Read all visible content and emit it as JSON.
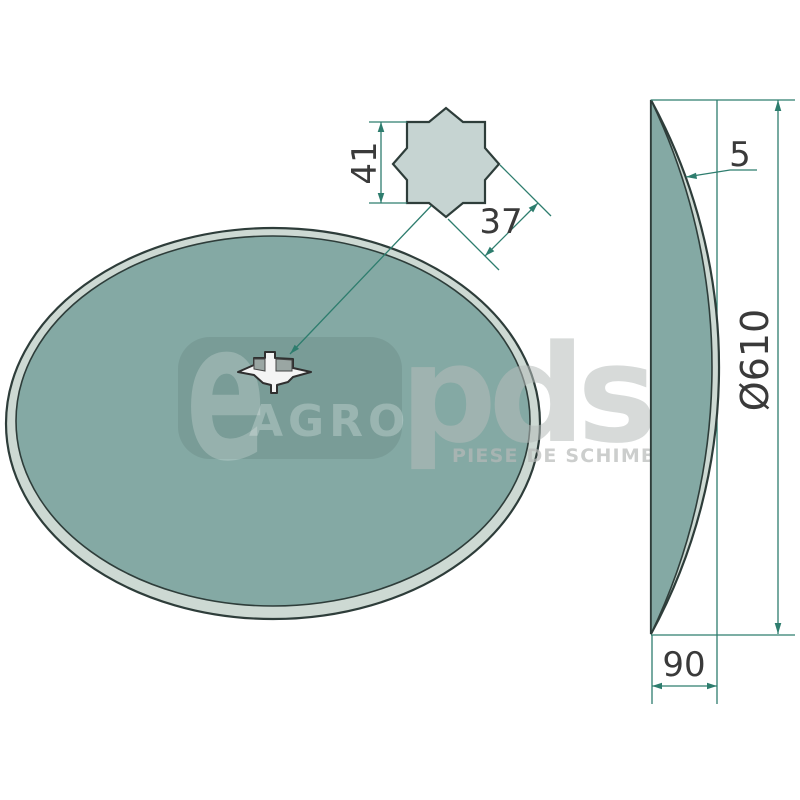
{
  "watermark": {
    "logo_e": "e",
    "logo_agro": "AGRO",
    "logo_pds": "pds",
    "tagline": "PIESE DE SCHIMB"
  },
  "dimensions": {
    "hub_square_height": "41",
    "hub_square_width": "37",
    "thickness": "5",
    "diameter": "Ø610",
    "concavity_depth": "90"
  },
  "colors": {
    "background": "#ffffff",
    "disc_face": "#84a9a4",
    "disc_rim": "#cdd9d3",
    "disc_outline": "#2e3d3a",
    "detail_fill": "#c6d4d2",
    "hole_fill": "#f4f4f4",
    "dimension_line": "#2e7d6e",
    "dimension_text": "#3a3a3a"
  }
}
